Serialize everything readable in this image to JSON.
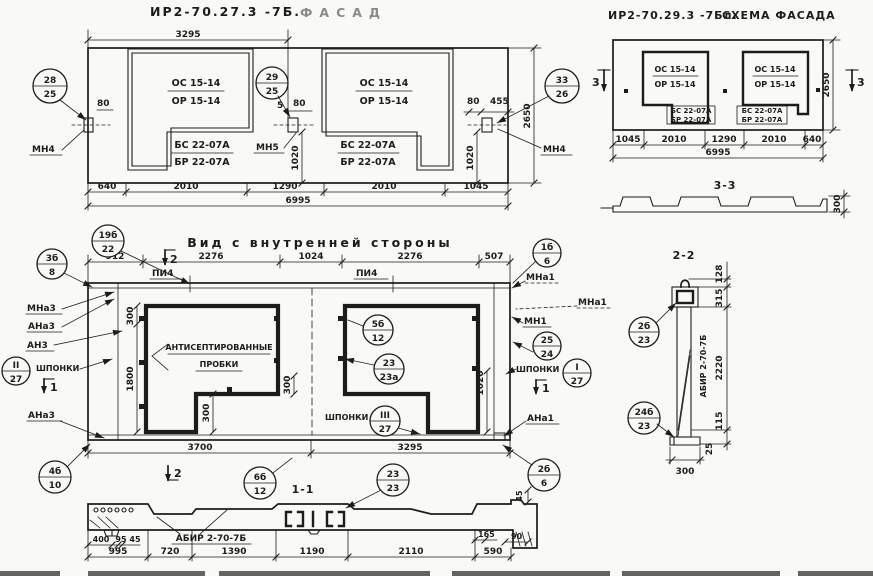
{
  "colors": {
    "ink": "#1c1c1c",
    "paper": "#f9f9f6"
  },
  "drawing": {
    "facade": {
      "title_code": "ИР2-70.27.3 -7Б.",
      "title_word": "ФАСАД",
      "win_mark_top": "ОС 15-14",
      "win_mark_bot": "ОР 15-14",
      "sill_mark_top": "БС 22-07А",
      "sill_mark_bot": "БР 22-07А",
      "dim_top": "3295",
      "dim_80": "80",
      "dim_5": "5",
      "dim_455": "455",
      "dim_1020": "1020",
      "dim_height": "2650",
      "dims_bottom": [
        "640",
        "2010",
        "1290",
        "2010",
        "1045"
      ],
      "dim_total": "6995",
      "label_mn4": "МН4",
      "label_mn5": "МН5"
    },
    "scheme": {
      "title_code": "ИР2-70.29.3 -7Бл.",
      "title_word": "СХЕМА ФАСАДА",
      "win_mark_top": "ОС 15-14",
      "win_mark_bot": "ОР 15-14",
      "sill_mark_top": "БС 22-07А",
      "sill_mark_bot": "БР 22-07А",
      "dims_bottom": [
        "1045",
        "2010",
        "1290",
        "2010",
        "640"
      ],
      "dim_total": "6995",
      "dim_height": "2650",
      "section_mark_3": "3"
    },
    "section33": {
      "title": "3-3",
      "dim_300": "300"
    },
    "section22": {
      "title": "2-2",
      "label_abir": "АБИР 2-70-7Б",
      "dims_right": [
        "128",
        "315",
        "2220",
        "115",
        "25"
      ],
      "dim_300": "300"
    },
    "inner": {
      "title": "Вид с внутренней стороны",
      "dims_top": [
        "912",
        "2276",
        "1024",
        "2276",
        "507"
      ],
      "dims_bottom": [
        "3700",
        "3295"
      ],
      "dim_300": "300",
      "dim_1800": "1800",
      "dim_1020": "1020",
      "label_pi4": "ПИ4",
      "label_mna3": "МНа3",
      "label_ana3": "АНа3",
      "label_an3": "АН3",
      "label_shponki": "ШПОНКИ",
      "label_mna1": "МНа1",
      "label_mn1": "МН1",
      "label_ana1": "АНа1",
      "plugs_line1": "АНТИСЕПТИРОВАННЫЕ",
      "plugs_line2": "ПРОБКИ",
      "section_mark_1": "1",
      "section_mark_2": "2"
    },
    "section11": {
      "title": "1-1",
      "label_abir": "АБИР 2-70-7Б",
      "dims_small": [
        "400",
        "95",
        "45"
      ],
      "dims_bottom": [
        "995",
        "720",
        "1390",
        "1190",
        "2110",
        "590"
      ],
      "dim_165": "165",
      "dim_90": "90",
      "dim_45": "45"
    },
    "callouts": {
      "c28_25": {
        "top": "28",
        "bot": "25"
      },
      "c29_25": {
        "top": "29",
        "bot": "25"
      },
      "c33_26": {
        "top": "33",
        "bot": "26"
      },
      "c19b_22": {
        "top": "19б",
        "bot": "22"
      },
      "c3b_8": {
        "top": "3б",
        "bot": "8"
      },
      "cII_27": {
        "top": "II",
        "bot": "27"
      },
      "c4b_10": {
        "top": "4б",
        "bot": "10"
      },
      "c5b_12": {
        "top": "5б",
        "bot": "12"
      },
      "c23_23a": {
        "top": "23",
        "bot": "23а"
      },
      "cIII_27": {
        "top": "III",
        "bot": "27"
      },
      "c1b_6": {
        "top": "1б",
        "bot": "6"
      },
      "c25_24": {
        "top": "25",
        "bot": "24"
      },
      "cI_27": {
        "top": "I",
        "bot": "27"
      },
      "c6b_12": {
        "top": "6б",
        "bot": "12"
      },
      "c23_23": {
        "top": "23",
        "bot": "23"
      },
      "c2b_6": {
        "top": "2б",
        "bot": "6"
      },
      "c2b_23": {
        "top": "2б",
        "bot": "23"
      },
      "c24b_23": {
        "top": "24б",
        "bot": "23"
      }
    }
  }
}
